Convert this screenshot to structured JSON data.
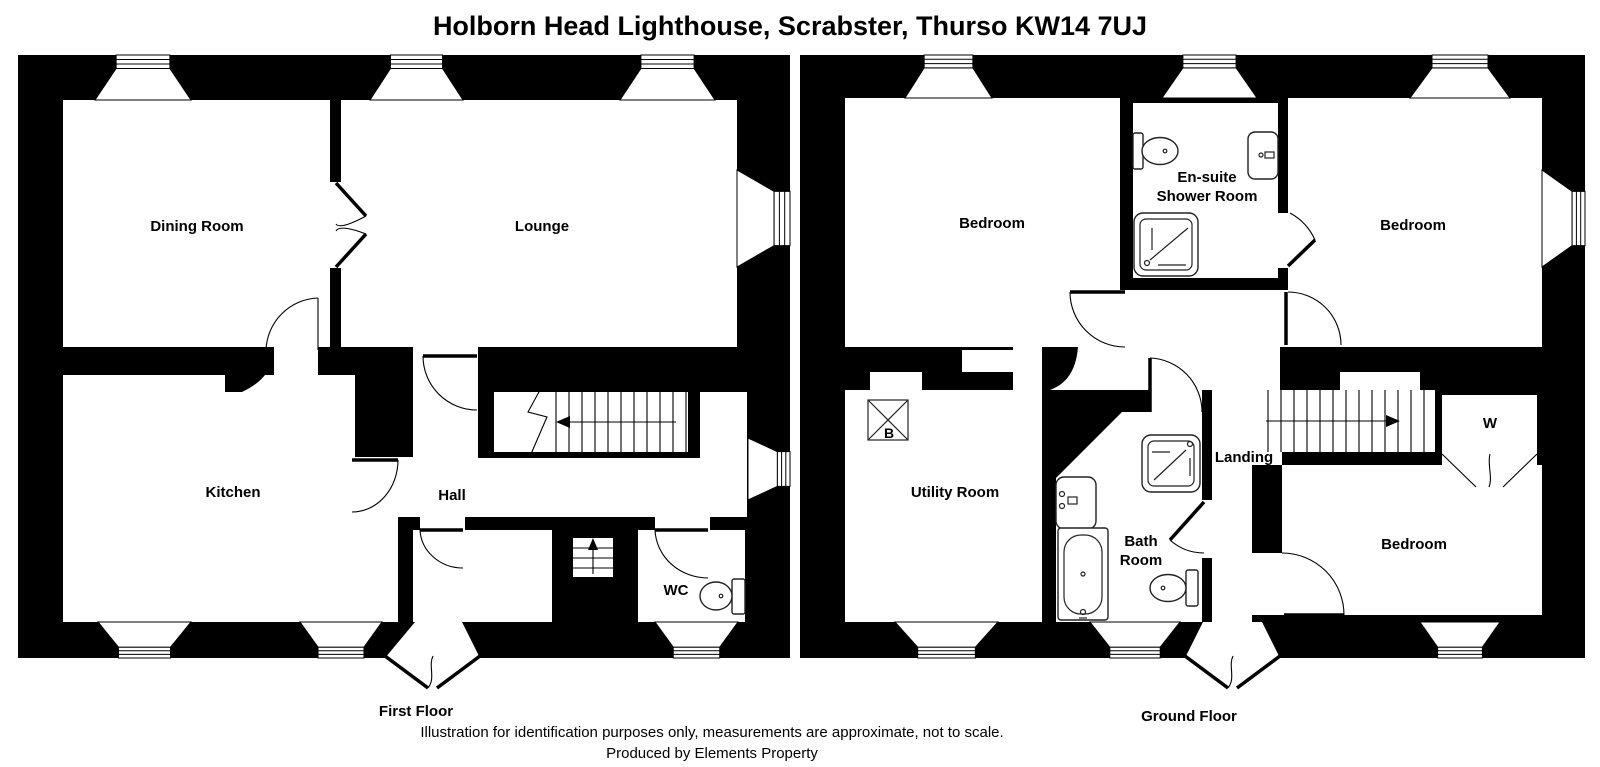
{
  "title": "Holborn Head Lighthouse, Scrabster, Thurso KW14 7UJ",
  "floors": {
    "first": {
      "label": "First Floor",
      "rooms": {
        "dining": "Dining Room",
        "lounge": "Lounge",
        "kitchen": "Kitchen",
        "hall": "Hall",
        "wc": "WC"
      }
    },
    "ground": {
      "label": "Ground Floor",
      "rooms": {
        "bedroom_top_left": "Bedroom",
        "ensuite_line1": "En-suite",
        "ensuite_line2": "Shower Room",
        "bedroom_top_right": "Bedroom",
        "utility": "Utility Room",
        "boiler": "B",
        "landing": "Landing",
        "bath_line1": "Bath",
        "bath_line2": "Room",
        "wardrobe": "W",
        "bedroom_bottom_right": "Bedroom"
      }
    }
  },
  "footer": {
    "disclaimer": "Illustration for identification purposes only, measurements are approximate, not to scale.",
    "credit": "Produced by Elements Property"
  },
  "colors": {
    "wall": "#000000",
    "background": "#ffffff",
    "fixture_line": "#222222"
  }
}
